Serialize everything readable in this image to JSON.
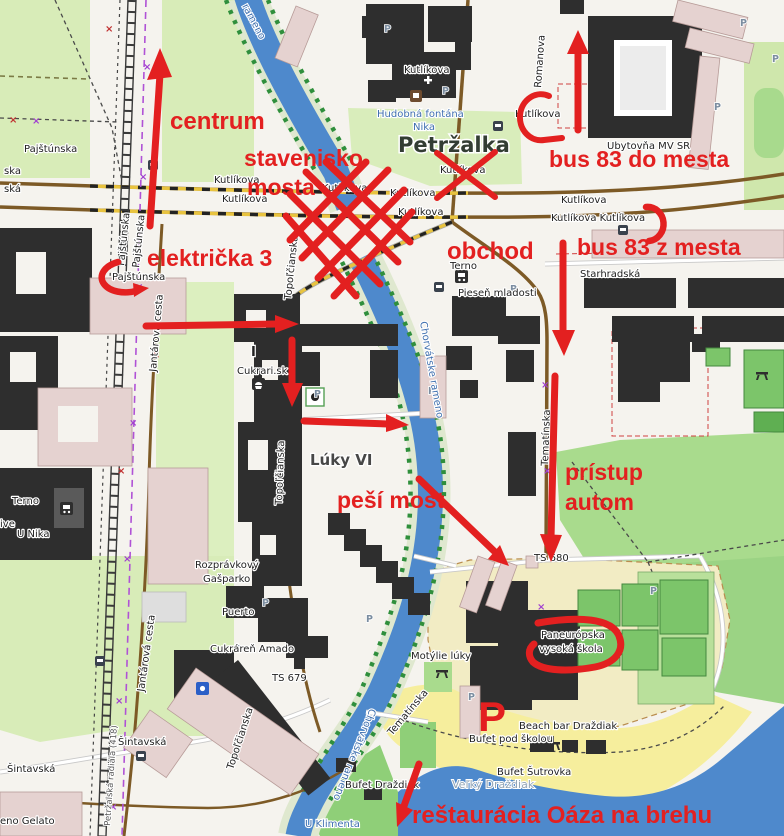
{
  "title": "Petržalka orientation map with hand-drawn directions",
  "map": {
    "parking_label": "P",
    "labels": [
      "Pajštúnska",
      "ska",
      "ská",
      "Pajštúnska",
      "Pajštúnska",
      "Pajštúnska",
      "Kutlíkova",
      "Kutlíkova",
      "Kutlíkova",
      "Kutlíkova",
      "Kutlíkova",
      "Kutlíkova",
      "Kutlíkova",
      "Kutlíkova Kutlíkova",
      "Kutlíkova",
      "Kutlíkova",
      "Romanova",
      "Hudobná fontána",
      "Nika",
      "Petržalka",
      "Ubytovňa MV SR",
      "Starhradská",
      "Terno",
      "Pieseň mladosti",
      "Topoľčianska",
      "Topoľčianska",
      "Topoľčianska",
      "Jantárová cesta",
      "Jantárová cesta",
      "Petržalská radiála (418)",
      "Cukrari.sk",
      "Lúky VI",
      "Terno",
      "ive",
      "U Nika",
      "Rozprávkový",
      "Gašparko",
      "Puerto",
      "Cukráreň Amado",
      "TS 679",
      "TS 680",
      "Šintavská",
      "Šintavská",
      "eno Gelato",
      "U Klimenta",
      "rameno",
      "Chorvátske rameno",
      "Chorvátske rameno",
      "Tematínska",
      "Tematínska",
      "Motýlie lúky",
      "Paneurópska",
      "vysoká škola",
      "Beach bar Draždiak",
      "Bufet pod školou",
      "Bufet Šutrovka",
      "Veľký Draždiak",
      "Bufet Draždiak",
      "I"
    ]
  },
  "annotations": {
    "color": "#e32020",
    "texts": [
      "centrum",
      "stavenisko",
      "mosta",
      "električka 3",
      "bus 83 do mesta",
      "bus 83 z mesta",
      "obchod",
      "prístup",
      "autom",
      "peší most",
      "reštaurácia Oáza na brehu",
      "P"
    ]
  }
}
